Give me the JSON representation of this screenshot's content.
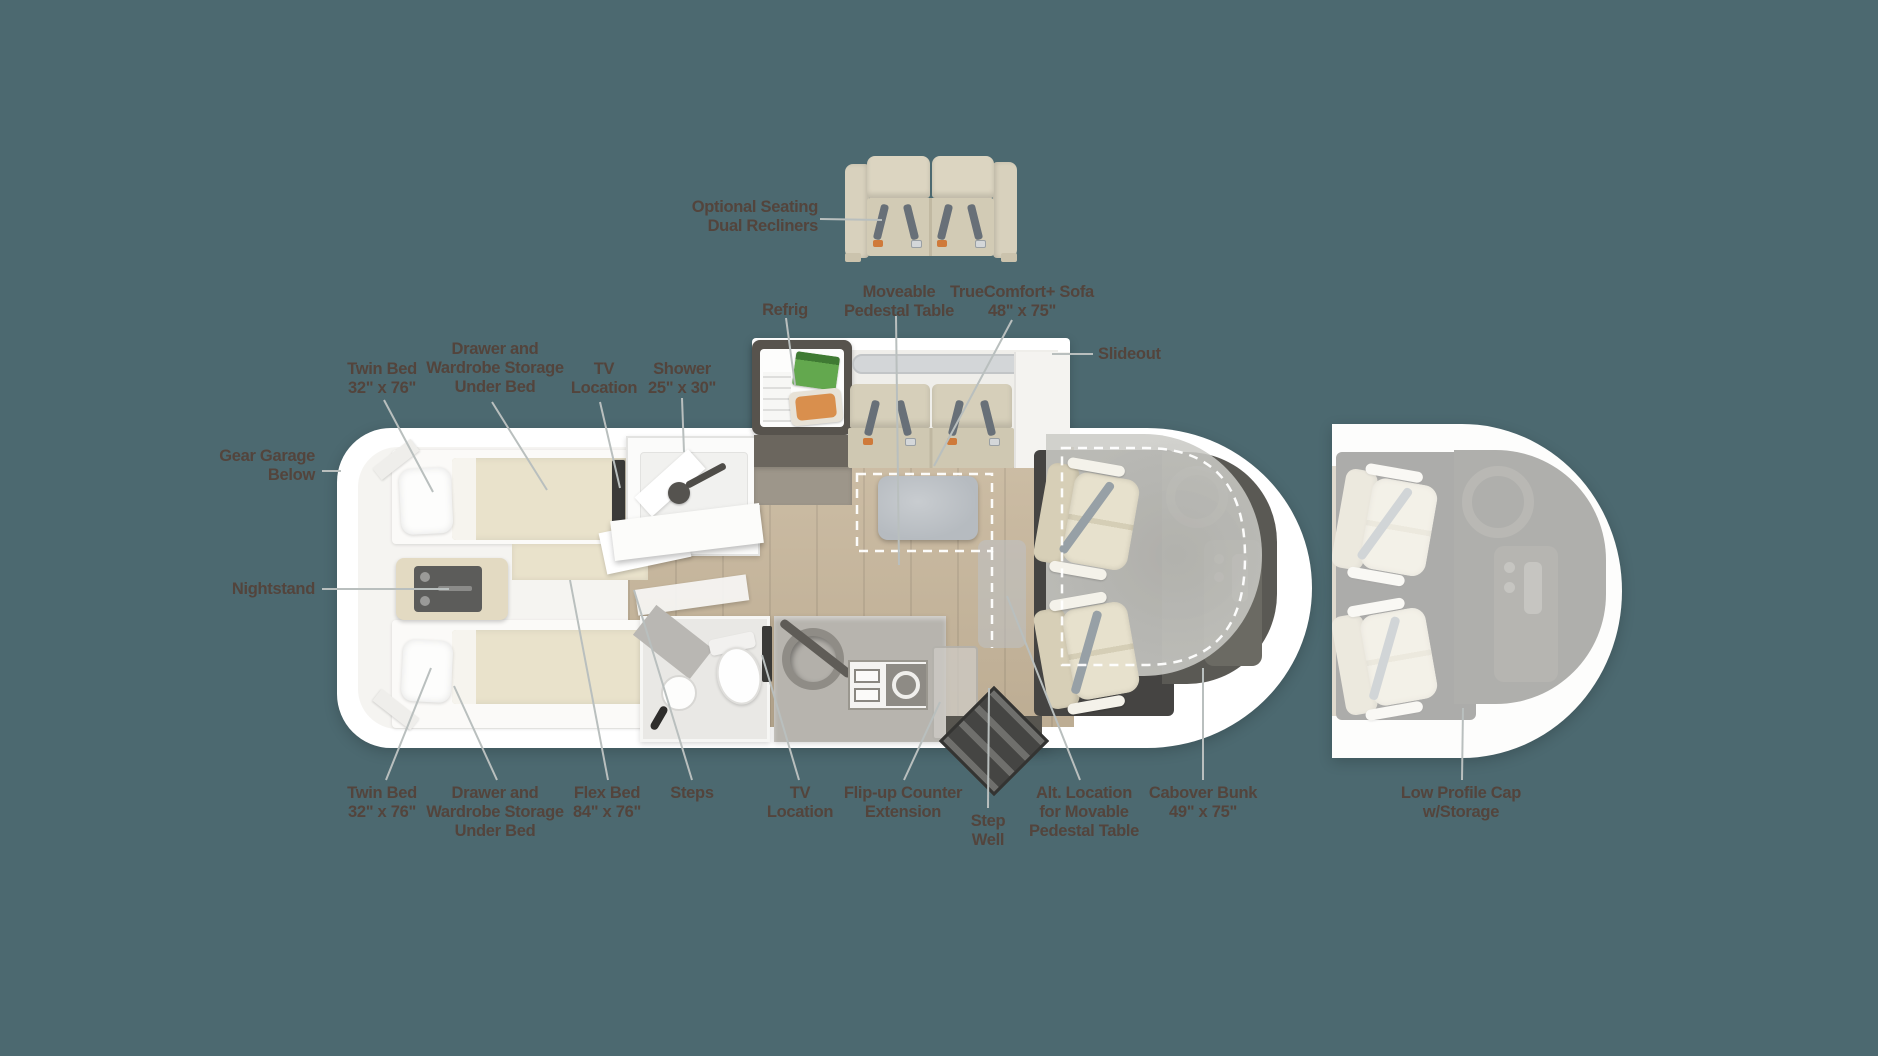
{
  "diagram_type": "RV motorhome floor plan (top view)",
  "palette": {
    "background": "#4C6970",
    "label_text": "#53443C",
    "body_shell": "#FFFFFF",
    "wood_floor": "#C7B69B",
    "upholstery_beige": "#D8D1BC",
    "mattress_beige": "#E9E2CB",
    "bunk_gray": "#CACAC6",
    "table_gray": "#B6BBC0",
    "dark_fixture": "#454442",
    "leader_line": "#B9BFBE"
  },
  "labels": {
    "optional_seating": "Optional Seating\nDual Recliners",
    "refrig": "Refrig",
    "moveable_pedestal_table": "Moveable\nPedestal Table",
    "truecomfort_sofa": "TrueComfort+ Sofa\n48\" x 75\"",
    "slideout": "Slideout",
    "twin_bed_top": "Twin Bed\n32\" x 76\"",
    "drawer_wardrobe_top": "Drawer and\nWardrobe Storage\nUnder Bed",
    "tv_location_top": "TV\nLocation",
    "shower": "Shower\n25\" x 30\"",
    "gear_garage": "Gear Garage\nBelow",
    "nightstand": "Nightstand",
    "twin_bed_bottom": "Twin Bed\n32\" x 76\"",
    "drawer_wardrobe_bottom": "Drawer and\nWardrobe Storage\nUnder Bed",
    "flex_bed": "Flex Bed\n84\" x 76\"",
    "steps": "Steps",
    "tv_location_bottom": "TV\nLocation",
    "flip_up_counter": "Flip-up Counter\nExtension",
    "step_well": "Step\nWell",
    "alt_table_location": "Alt. Location\nfor Movable\nPedestal Table",
    "cabover_bunk": "Cabover Bunk\n49\" x 75\"",
    "low_profile_cap": "Low Profile Cap\nw/Storage"
  }
}
